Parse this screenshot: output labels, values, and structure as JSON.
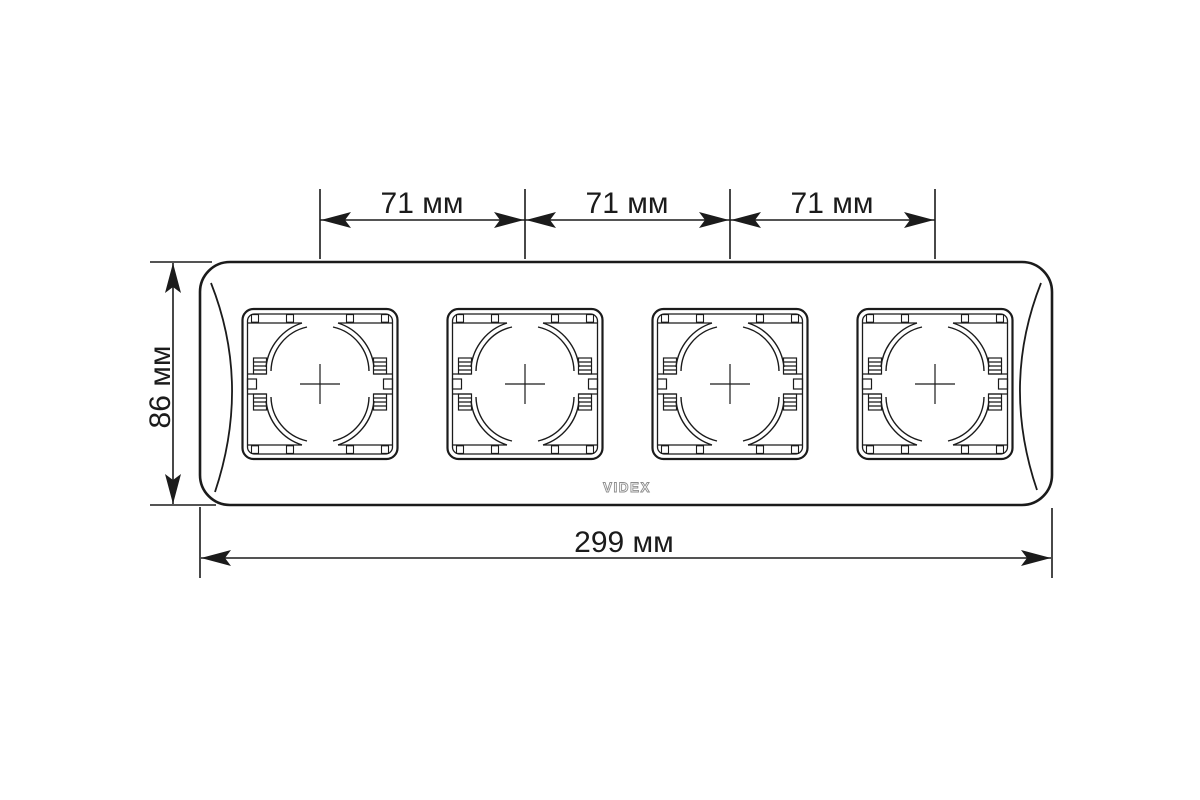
{
  "drawing": {
    "spacing_labels": [
      "71 мм",
      "71 мм",
      "71 мм"
    ],
    "height_label": "86 мм",
    "width_label": "299 мм",
    "logo_text": "VIDEX"
  },
  "colors": {
    "background": "#ffffff",
    "line": "#1b1b1b",
    "logo_outline": "#8d8d8d"
  }
}
